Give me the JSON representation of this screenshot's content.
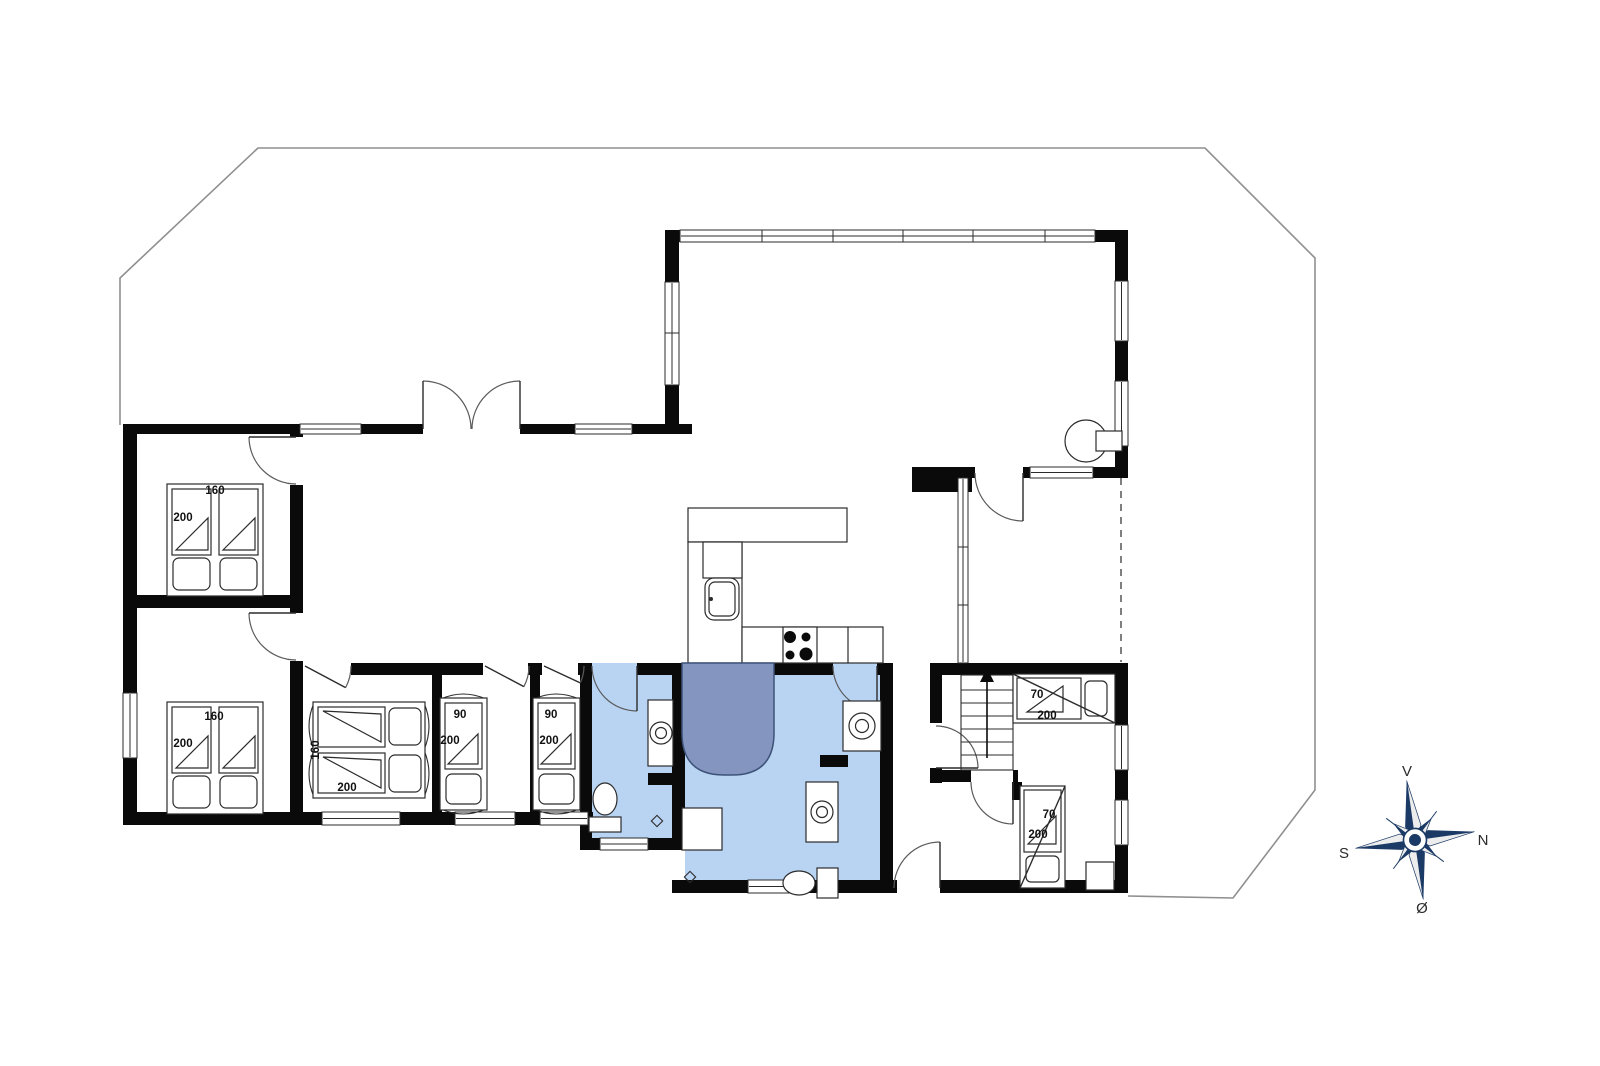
{
  "meta": {
    "title": "Summerhouse floor plan"
  },
  "colors": {
    "wall": "#0a0a0a",
    "line": "#2b2b2b",
    "door": "#5a5a5a",
    "bathFloor": "#b9d4f3",
    "shower": "#8496c0",
    "showerStroke": "#3d5378",
    "terrace": "#8f8f8f",
    "dash": "#555555",
    "label": "#111111",
    "compassNavy": "#1b3a66",
    "compassLight": "#ededed",
    "compassText": "#2b2b2b"
  },
  "plan": {
    "terrace": {
      "points": [
        [
          120,
          425
        ],
        [
          120,
          278
        ],
        [
          258,
          148
        ],
        [
          1205,
          148
        ],
        [
          1315,
          258
        ],
        [
          1315,
          790
        ],
        [
          1233,
          898
        ],
        [
          1128,
          896
        ]
      ]
    },
    "floors": [
      [
        592,
        675,
        80,
        163
      ],
      [
        685,
        675,
        195,
        205
      ]
    ],
    "walls": [
      [
        123,
        424,
        569,
        10
      ],
      [
        123,
        424,
        14,
        401
      ],
      [
        123,
        595,
        180,
        13
      ],
      [
        290,
        424,
        13,
        401
      ],
      [
        123,
        812,
        470,
        13
      ],
      [
        432,
        663,
        10,
        162
      ],
      [
        530,
        663,
        10,
        162
      ],
      [
        580,
        663,
        12,
        187
      ],
      [
        303,
        663,
        590,
        12
      ],
      [
        672,
        663,
        13,
        187
      ],
      [
        580,
        838,
        105,
        12
      ],
      [
        672,
        880,
        456,
        13
      ],
      [
        880,
        663,
        13,
        230
      ],
      [
        930,
        663,
        12,
        120
      ],
      [
        942,
        663,
        186,
        12
      ],
      [
        1115,
        663,
        13,
        230
      ],
      [
        942,
        770,
        76,
        12
      ],
      [
        665,
        230,
        14,
        204
      ],
      [
        665,
        230,
        463,
        12
      ],
      [
        1115,
        230,
        13,
        247
      ],
      [
        912,
        467,
        216,
        11
      ],
      [
        912,
        467,
        60,
        25
      ],
      [
        648,
        773,
        37,
        12
      ],
      [
        820,
        755,
        28,
        12
      ],
      [
        1012,
        782,
        10,
        18
      ]
    ],
    "openings": [
      {
        "n": "opening-bedroom1-door",
        "x": 290,
        "y": 437,
        "w": 13,
        "h": 48
      },
      {
        "n": "opening-bedroom2-door",
        "x": 290,
        "y": 613,
        "w": 13,
        "h": 48
      },
      {
        "n": "opening-entrance",
        "x": 423,
        "y": 424,
        "w": 97,
        "h": 10
      },
      {
        "n": "opening-bedroom3-door",
        "x": 303,
        "y": 663,
        "w": 48,
        "h": 12
      },
      {
        "n": "opening-bedroom4-door",
        "x": 483,
        "y": 663,
        "w": 45,
        "h": 12
      },
      {
        "n": "opening-bedroom5-door",
        "x": 542,
        "y": 663,
        "w": 36,
        "h": 12
      },
      {
        "n": "opening-bath1-door",
        "x": 592,
        "y": 663,
        "w": 45,
        "h": 12,
        "f": "b"
      },
      {
        "n": "opening-bath2-door",
        "x": 833,
        "y": 663,
        "w": 44,
        "h": 12,
        "f": "b"
      },
      {
        "n": "opening-porch-door",
        "x": 975,
        "y": 467,
        "w": 48,
        "h": 11
      },
      {
        "n": "opening-stair-room-door",
        "x": 930,
        "y": 723,
        "w": 12,
        "h": 45
      },
      {
        "n": "opening-bunkroom2-door",
        "x": 971,
        "y": 770,
        "w": 42,
        "h": 12
      },
      {
        "n": "opening-back-door",
        "x": 897,
        "y": 880,
        "w": 43,
        "h": 13
      }
    ],
    "windows": [
      {
        "n": "window-entry-west",
        "x": 300,
        "y": 424,
        "w": 61,
        "h": 10,
        "dir": "h"
      },
      {
        "n": "window-entry-east",
        "x": 575,
        "y": 424,
        "w": 57,
        "h": 10,
        "dir": "h"
      },
      {
        "n": "window-band-north",
        "x": 680,
        "y": 230,
        "w": 415,
        "h": 12,
        "dir": "h",
        "divs": [
          762,
          833,
          903,
          973,
          1045
        ]
      },
      {
        "n": "window-porch-north",
        "x": 1030,
        "y": 467,
        "w": 63,
        "h": 11,
        "dir": "h"
      },
      {
        "n": "window-bedroom3-south",
        "x": 322,
        "y": 812,
        "w": 78,
        "h": 13,
        "dir": "h"
      },
      {
        "n": "window-bedroom4-south",
        "x": 455,
        "y": 812,
        "w": 60,
        "h": 13,
        "dir": "h"
      },
      {
        "n": "window-bedroom5-south",
        "x": 540,
        "y": 812,
        "w": 48,
        "h": 13,
        "dir": "h"
      },
      {
        "n": "window-bath1-south",
        "x": 600,
        "y": 838,
        "w": 48,
        "h": 12,
        "dir": "h"
      },
      {
        "n": "window-bath2-south",
        "x": 748,
        "y": 880,
        "w": 49,
        "h": 13,
        "dir": "h"
      },
      {
        "n": "window-bedroom2-west",
        "x": 123,
        "y": 693,
        "w": 14,
        "h": 65,
        "dir": "v"
      },
      {
        "n": "window-living-west",
        "x": 665,
        "y": 282,
        "w": 14,
        "h": 103,
        "dir": "v",
        "divs": [
          333
        ]
      },
      {
        "n": "window-living-east1",
        "x": 1115,
        "y": 281,
        "w": 13,
        "h": 60,
        "dir": "v"
      },
      {
        "n": "window-living-east2",
        "x": 1115,
        "y": 381,
        "w": 13,
        "h": 65,
        "dir": "v"
      },
      {
        "n": "window-wing-east1",
        "x": 1115,
        "y": 725,
        "w": 13,
        "h": 45,
        "dir": "v"
      },
      {
        "n": "window-wing-east2",
        "x": 1115,
        "y": 800,
        "w": 13,
        "h": 45,
        "dir": "v"
      },
      {
        "n": "window-glass-partition",
        "x": 958,
        "y": 478,
        "w": 10,
        "h": 185,
        "dir": "v",
        "divs": [
          547,
          605
        ]
      }
    ],
    "doors": [
      {
        "n": "door-bedroom1",
        "hx": 296,
        "hy": 437,
        "r": 47,
        "a0": 90,
        "a1": 180
      },
      {
        "n": "door-bedroom2",
        "hx": 296,
        "hy": 613,
        "r": 47,
        "a0": 90,
        "a1": 180
      },
      {
        "n": "door-bedroom3",
        "hx": 305,
        "hy": 666,
        "r": 46,
        "a0": 0,
        "a1": 28
      },
      {
        "n": "door-bedroom4",
        "hx": 485,
        "hy": 666,
        "r": 44,
        "a0": 0,
        "a1": 28
      },
      {
        "n": "door-bedroom5",
        "hx": 544,
        "hy": 666,
        "r": 40,
        "a0": 0,
        "a1": 25
      },
      {
        "n": "door-bath1",
        "hx": 637,
        "hy": 666,
        "r": 45,
        "a0": 180,
        "a1": 90
      },
      {
        "n": "door-bath2",
        "hx": 877,
        "hy": 666,
        "r": 44,
        "a0": 180,
        "a1": 90
      },
      {
        "n": "door-entrance-left",
        "hx": 423,
        "hy": 429,
        "r": 48,
        "a0": 0,
        "a1": 270
      },
      {
        "n": "door-entrance-right",
        "hx": 520,
        "hy": 429,
        "r": 48,
        "a0": 180,
        "a1": 270
      },
      {
        "n": "door-porch",
        "hx": 1023,
        "hy": 473,
        "r": 48,
        "a0": 180,
        "a1": 90
      },
      {
        "n": "door-stair-room",
        "hx": 936,
        "hy": 768,
        "r": 42,
        "a0": 270,
        "a1": 0
      },
      {
        "n": "door-bunkroom2",
        "hx": 1013,
        "hy": 782,
        "r": 42,
        "a0": 180,
        "a1": 90
      },
      {
        "n": "door-back",
        "hx": 940,
        "hy": 888,
        "r": 46,
        "a0": 180,
        "a1": 270
      }
    ],
    "dashes": [
      {
        "x1": 1121,
        "y1": 478,
        "x2": 1121,
        "y2": 662
      }
    ],
    "fixtures": [
      {
        "n": "kitchen-counter-top",
        "t": "rect",
        "x": 688,
        "y": 508,
        "w": 159,
        "h": 34
      },
      {
        "n": "kitchen-counter-left",
        "t": "rect",
        "x": 688,
        "y": 542,
        "w": 54,
        "h": 121
      },
      {
        "n": "kitchen-appliance",
        "t": "rect",
        "x": 703,
        "y": 542,
        "w": 39,
        "h": 36
      },
      {
        "n": "kitchen-counter-bottom",
        "t": "rect",
        "x": 742,
        "y": 627,
        "w": 141,
        "h": 36
      },
      {
        "n": "kitchen-counter-divider",
        "t": "line",
        "x1": 848,
        "y1": 627,
        "x2": 848,
        "y2": 663
      },
      {
        "n": "kitchen-sink",
        "t": "ksink",
        "x": 705,
        "y": 578,
        "w": 34,
        "h": 42
      },
      {
        "n": "stove-burners",
        "t": "stove",
        "x": 783,
        "y": 627,
        "w": 34,
        "h": 36,
        "b": [
          [
            790,
            637,
            6
          ],
          [
            806,
            637,
            4.5
          ],
          [
            790,
            655,
            4.5
          ],
          [
            806,
            654,
            6.5
          ]
        ]
      },
      {
        "n": "wood-stove",
        "t": "woodstove",
        "cx": 1086,
        "cy": 441,
        "r": 21,
        "rx": 1096,
        "ry": 431,
        "rw": 26,
        "rh": 20
      },
      {
        "n": "bath1-sink",
        "t": "sink",
        "x": 648,
        "y": 700,
        "w": 25,
        "h": 66,
        "cx": 661,
        "cy": 733
      },
      {
        "n": "bath1-toilet",
        "t": "toilet",
        "cx": 605,
        "cy": 799,
        "rx": 12,
        "ry": 16,
        "tx": 589,
        "ty": 817,
        "tw": 32,
        "th": 15
      },
      {
        "n": "shower",
        "t": "shower",
        "x": 682,
        "y": 663,
        "w": 92,
        "h": 112,
        "r": 42
      },
      {
        "n": "bath2-cabinet",
        "t": "rect",
        "x": 682,
        "y": 808,
        "w": 40,
        "h": 42
      },
      {
        "n": "washing-machine",
        "t": "washer",
        "x": 843,
        "y": 701,
        "w": 38,
        "h": 50
      },
      {
        "n": "bath2-sink",
        "t": "sink",
        "x": 806,
        "y": 782,
        "w": 32,
        "h": 60,
        "cx": 822,
        "cy": 812
      },
      {
        "n": "bath2-toilet",
        "t": "toilet",
        "cx": 799,
        "cy": 883,
        "rx": 16,
        "ry": 12,
        "tx": 817,
        "ty": 868,
        "tw": 21,
        "th": 30
      },
      {
        "n": "floor-drain",
        "t": "drain",
        "cx": 657,
        "cy": 821
      },
      {
        "n": "floor-drain",
        "t": "drain",
        "cx": 690,
        "cy": 877
      },
      {
        "n": "stairs",
        "t": "stairs",
        "x": 961,
        "y": 675,
        "w": 52,
        "h": 95,
        "treads": [
          690,
          703,
          716,
          729,
          742,
          755
        ],
        "ax": 987,
        "ay1": 758,
        "ay2": 682
      },
      {
        "n": "closet",
        "t": "rect",
        "x": 1086,
        "y": 862,
        "w": 28,
        "h": 28
      }
    ],
    "beds": [
      {
        "n": "bed-double-bedroom1",
        "type": "double-v",
        "x": 167,
        "y": 476
      },
      {
        "n": "bed-double-bedroom2",
        "type": "double-v",
        "x": 167,
        "y": 694
      },
      {
        "n": "bed-double-bedroom3",
        "type": "double-h",
        "x": 305,
        "y": 702
      },
      {
        "n": "bed-single-bedroom4",
        "type": "single-v",
        "x": 440,
        "y": 690
      },
      {
        "n": "bed-single-bedroom5",
        "type": "single-v",
        "x": 533,
        "y": 690
      },
      {
        "n": "bunk-bed-room1",
        "type": "bunk-h",
        "x": 1013,
        "y": 674
      },
      {
        "n": "bunk-bed-room2",
        "type": "bunk-v",
        "x": 1020,
        "y": 786
      }
    ],
    "labels": [
      {
        "t": "160",
        "x": 215,
        "y": 491
      },
      {
        "t": "200",
        "x": 183,
        "y": 518
      },
      {
        "t": "160",
        "x": 214,
        "y": 717
      },
      {
        "t": "200",
        "x": 183,
        "y": 744
      },
      {
        "t": "160",
        "x": 316,
        "y": 750,
        "rot": -90
      },
      {
        "t": "200",
        "x": 347,
        "y": 788
      },
      {
        "t": "90",
        "x": 460,
        "y": 715
      },
      {
        "t": "200",
        "x": 450,
        "y": 741
      },
      {
        "t": "90",
        "x": 551,
        "y": 715
      },
      {
        "t": "200",
        "x": 549,
        "y": 741
      },
      {
        "t": "70",
        "x": 1037,
        "y": 695
      },
      {
        "t": "200",
        "x": 1047,
        "y": 716
      },
      {
        "t": "70",
        "x": 1049,
        "y": 815
      },
      {
        "t": "200",
        "x": 1038,
        "y": 835
      }
    ]
  },
  "compass": {
    "cx": 1415,
    "cy": 840,
    "rotation": -8,
    "labels": [
      {
        "t": "V",
        "x": 1407,
        "y": 776
      },
      {
        "t": "N",
        "x": 1483,
        "y": 845
      },
      {
        "t": "S",
        "x": 1344,
        "y": 858
      },
      {
        "t": "Ø",
        "x": 1422,
        "y": 913
      }
    ]
  }
}
